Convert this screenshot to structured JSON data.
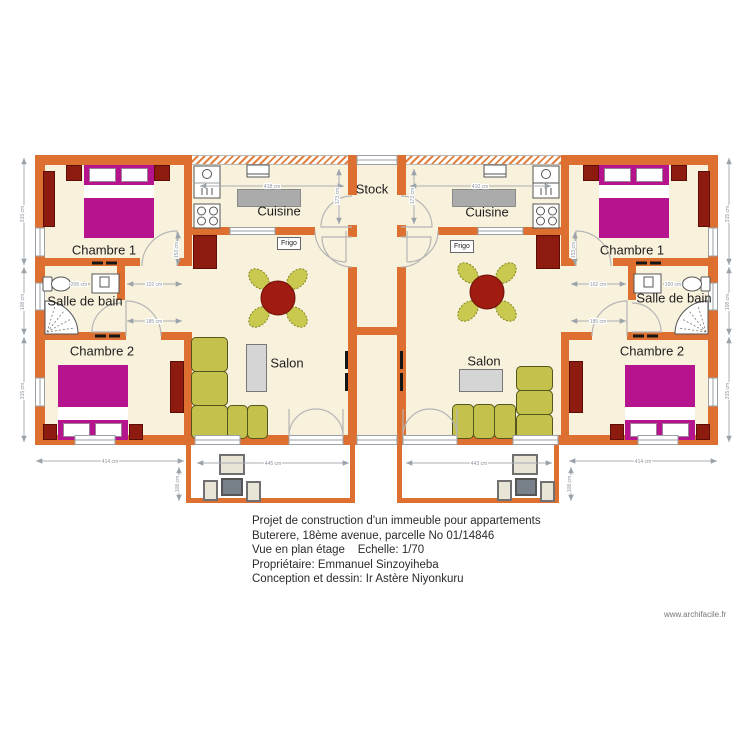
{
  "plan": {
    "rooms": {
      "chambre1": "Chambre 1",
      "chambre2": "Chambre 2",
      "salle_de_bain": "Salle de bain",
      "cuisine": "Cuisine",
      "salon": "Salon",
      "stock": "Stock",
      "frigo": "Frigo"
    },
    "dimensions": {
      "side_top": "315 cm",
      "side_mid": "108 cm",
      "side_bottom": "315 cm",
      "bottom_left": "414 cm",
      "bottom_right": "414 cm",
      "terrace_left": "445 cm",
      "terrace_right": "443 cm",
      "terrace_height": "108 cm",
      "kitchen_left": "418 cm",
      "kitchen_right": "410 cm",
      "kitchen_depth": "173 cm",
      "hall_width": "102 cm",
      "hall_length": "185 cm",
      "bath_left": "205 cm",
      "bath_right": "100 cm",
      "door_height": "153 cm"
    }
  },
  "title_block": {
    "line1": "Projet de construction d'un immeuble pour appartements",
    "line2": "Buterere, 18ème avenue, parcelle No 01/14846",
    "line3": "Vue en plan étage    Echelle: 1/70",
    "line4": "Propriétaire: Emmanuel Sinzoyiheba",
    "line5": "Conception et dessin: Ir Astère Niyonkuru"
  },
  "watermark": "www.archifacile.fr",
  "colors": {
    "wall": "#DD7031",
    "floor": "#F8F1DC",
    "bed": "#B5148E",
    "dark_furniture": "#8E1B10",
    "sofa": "#C4C24C",
    "dimension": "#A8AEB5"
  }
}
